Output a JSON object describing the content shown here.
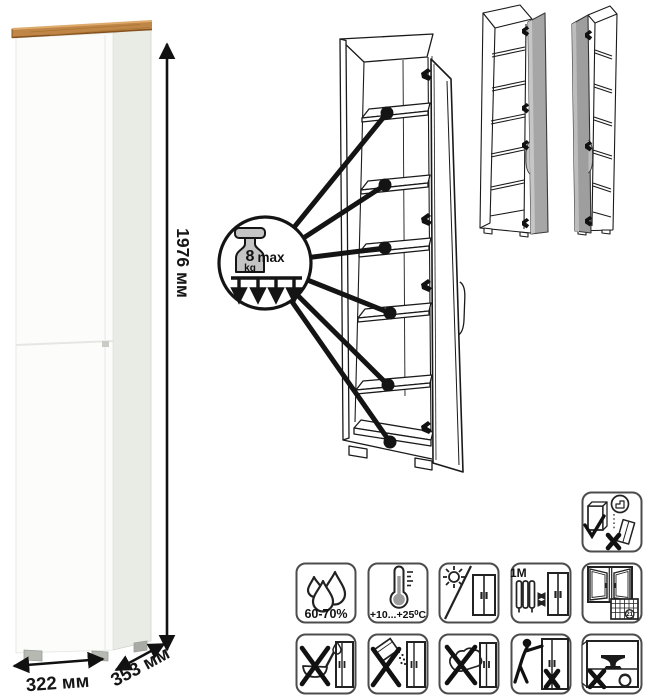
{
  "product": {
    "height": "1976 мм",
    "width": "322 мм",
    "depth": "353 мм",
    "body_color": "#ffffff",
    "top_color": "#bf8647"
  },
  "shelf_load": {
    "value": "8",
    "unit": "kg",
    "qualifier": "max",
    "callouts": 6
  },
  "door_variants": {
    "count": 2,
    "door_color": "#a6a6a6"
  },
  "care_pictograms": [
    {
      "id": "humidity-range",
      "label": "60-70%"
    },
    {
      "id": "temperature-range",
      "label": "+10...+25⁰C"
    },
    {
      "id": "no-direct-sunlight"
    },
    {
      "id": "min-distance-from-heat",
      "label": "≥1М"
    },
    {
      "id": "ventilation",
      "calendar_day": "21"
    },
    {
      "id": "anchor-to-wall"
    },
    {
      "id": "no-liquid-cleaners"
    },
    {
      "id": "no-abrasive-powders"
    },
    {
      "id": "no-wet-sponge"
    },
    {
      "id": "no-dragging"
    },
    {
      "id": "no-overloading"
    }
  ]
}
